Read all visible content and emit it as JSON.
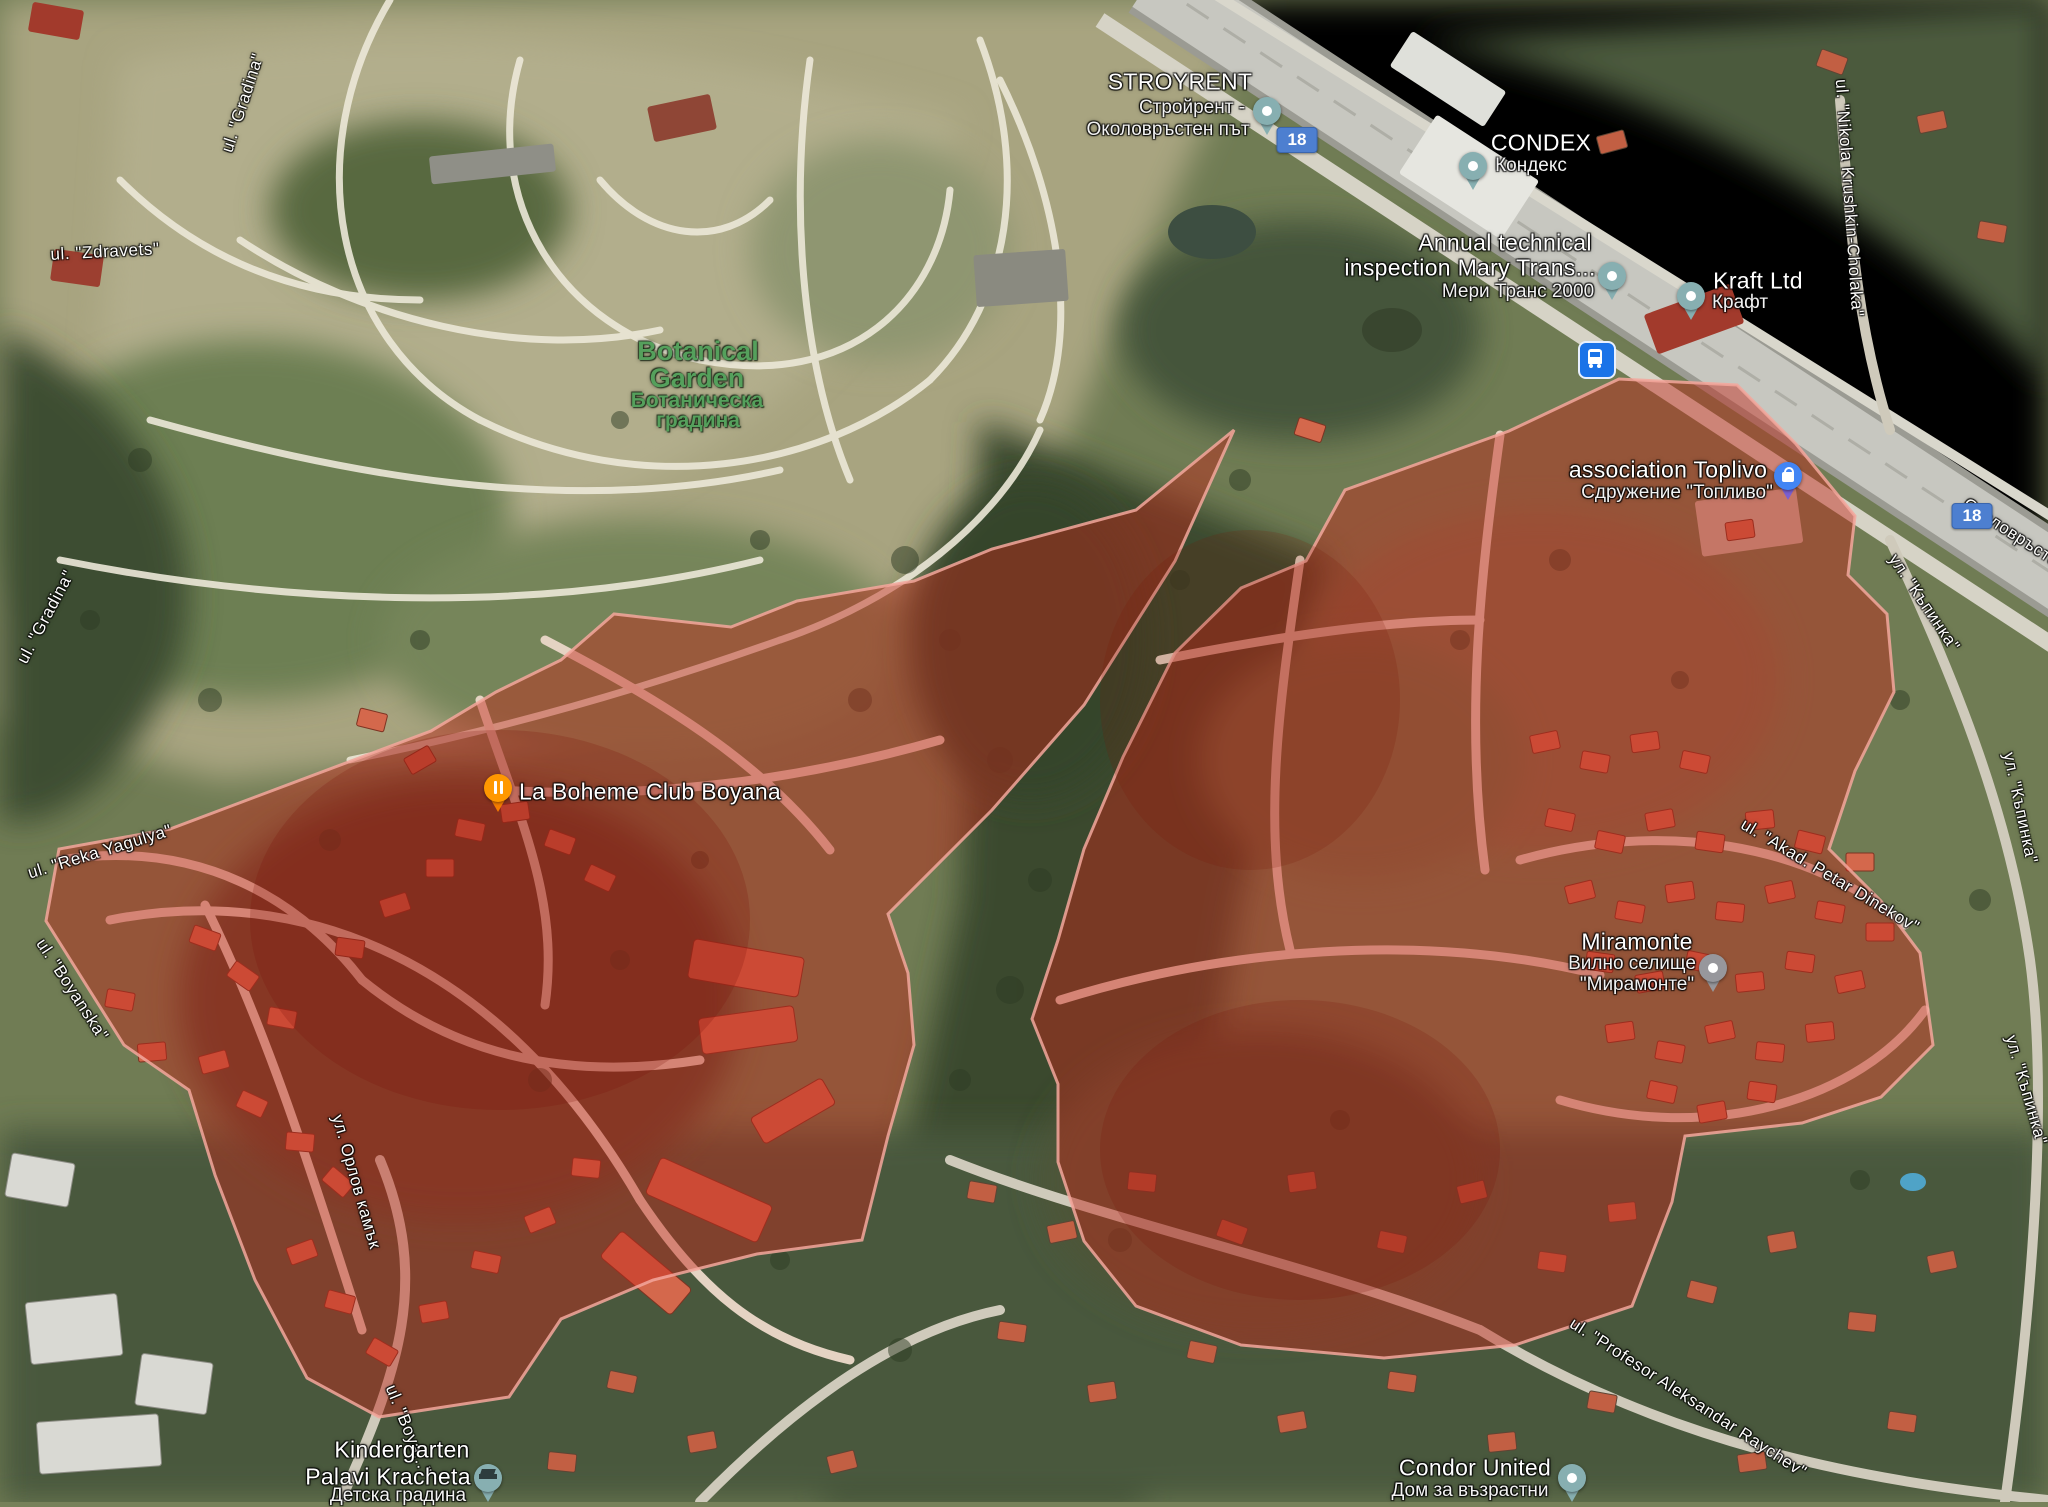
{
  "pois": {
    "stroyrent": {
      "name": "STROYRENT",
      "native": "Стройрент -",
      "extra": "Околовръстен път",
      "pin": "teal-place-pin"
    },
    "condex": {
      "name": "CONDEX",
      "native": "Кондекс",
      "pin": "teal-place-pin"
    },
    "mary_trans": {
      "line1": "Annual technical",
      "line2": "inspection Mary Trans...",
      "native": "Мери Транс 2000",
      "pin": "teal-place-pin"
    },
    "kraft": {
      "name": "Kraft Ltd",
      "native": "Крафт",
      "pin": "teal-place-pin"
    },
    "botanical_garden": {
      "name_line1": "Botanical",
      "name_line2": "Garden",
      "native_line1": "Ботаническа",
      "native_line2": "градина"
    },
    "toplivo": {
      "name": "association Toplivo",
      "native": "Сдружение \"Топливо\"",
      "pin": "shopping-bag-pin"
    },
    "la_boheme": {
      "name": "La Boheme Club Boyana",
      "pin": "restaurant-pin"
    },
    "miramonte": {
      "name": "Miramonte",
      "native_line1": "Вилно селище",
      "native_line2": "\"Мирамонте\"",
      "pin": "gray-place-pin"
    },
    "kindergarten": {
      "line1": "Kindergarten",
      "line2": "Palavi Kracheta",
      "native": "Детска градина",
      "pin": "school-pin"
    },
    "condor": {
      "name": "Condor United",
      "native": "Дом за възрастни",
      "pin": "teal-place-pin"
    }
  },
  "streets": {
    "zdravets": "ul. \"Zdravets\"",
    "gradina_top": "ul. \"Gradina\"",
    "gradina_left": "ul. \"Gradina\"",
    "reka_yagulya": "ul. \"Reka Yagulya\"",
    "boyanska": "ul. \"Boyanska\"",
    "orlov_kamak": "ул. Орлов камък",
    "boyana_bottom": "ul. \"Boya...\"",
    "nikola_krushkin": "ul. \"Nikola Krushkin-Cholaka\"",
    "kapinka_1": "ул. \"Къпинка\"",
    "kapinka_2": "ул. \"Къпинка\"",
    "kapinka_3": "ул. \"Къпинка\"",
    "akad_petar_dinekov": "ul. \"Akad. Petar Dinekov\"",
    "profesor_raychev": "ul. \"Profesor Aleksandar Raychev\"",
    "okolovrasten_put": "Околовръстен път"
  },
  "shields": {
    "ring_road": "18"
  },
  "overlay": {
    "zones": [
      "west-boyana-zone",
      "east-miramonte-zone"
    ],
    "fill": "#c1271b",
    "fill_opacity": 0.46,
    "border": "#f3a79c"
  },
  "colors": {
    "park_label_green": "#55a05c",
    "shield_blue": "#4d7fd0",
    "transit_blue": "#1a73e8",
    "pin_teal": "#87afb1",
    "pin_gray": "#97979c",
    "pin_orange": "#ff9800",
    "pin_blue": "#4285f4"
  }
}
